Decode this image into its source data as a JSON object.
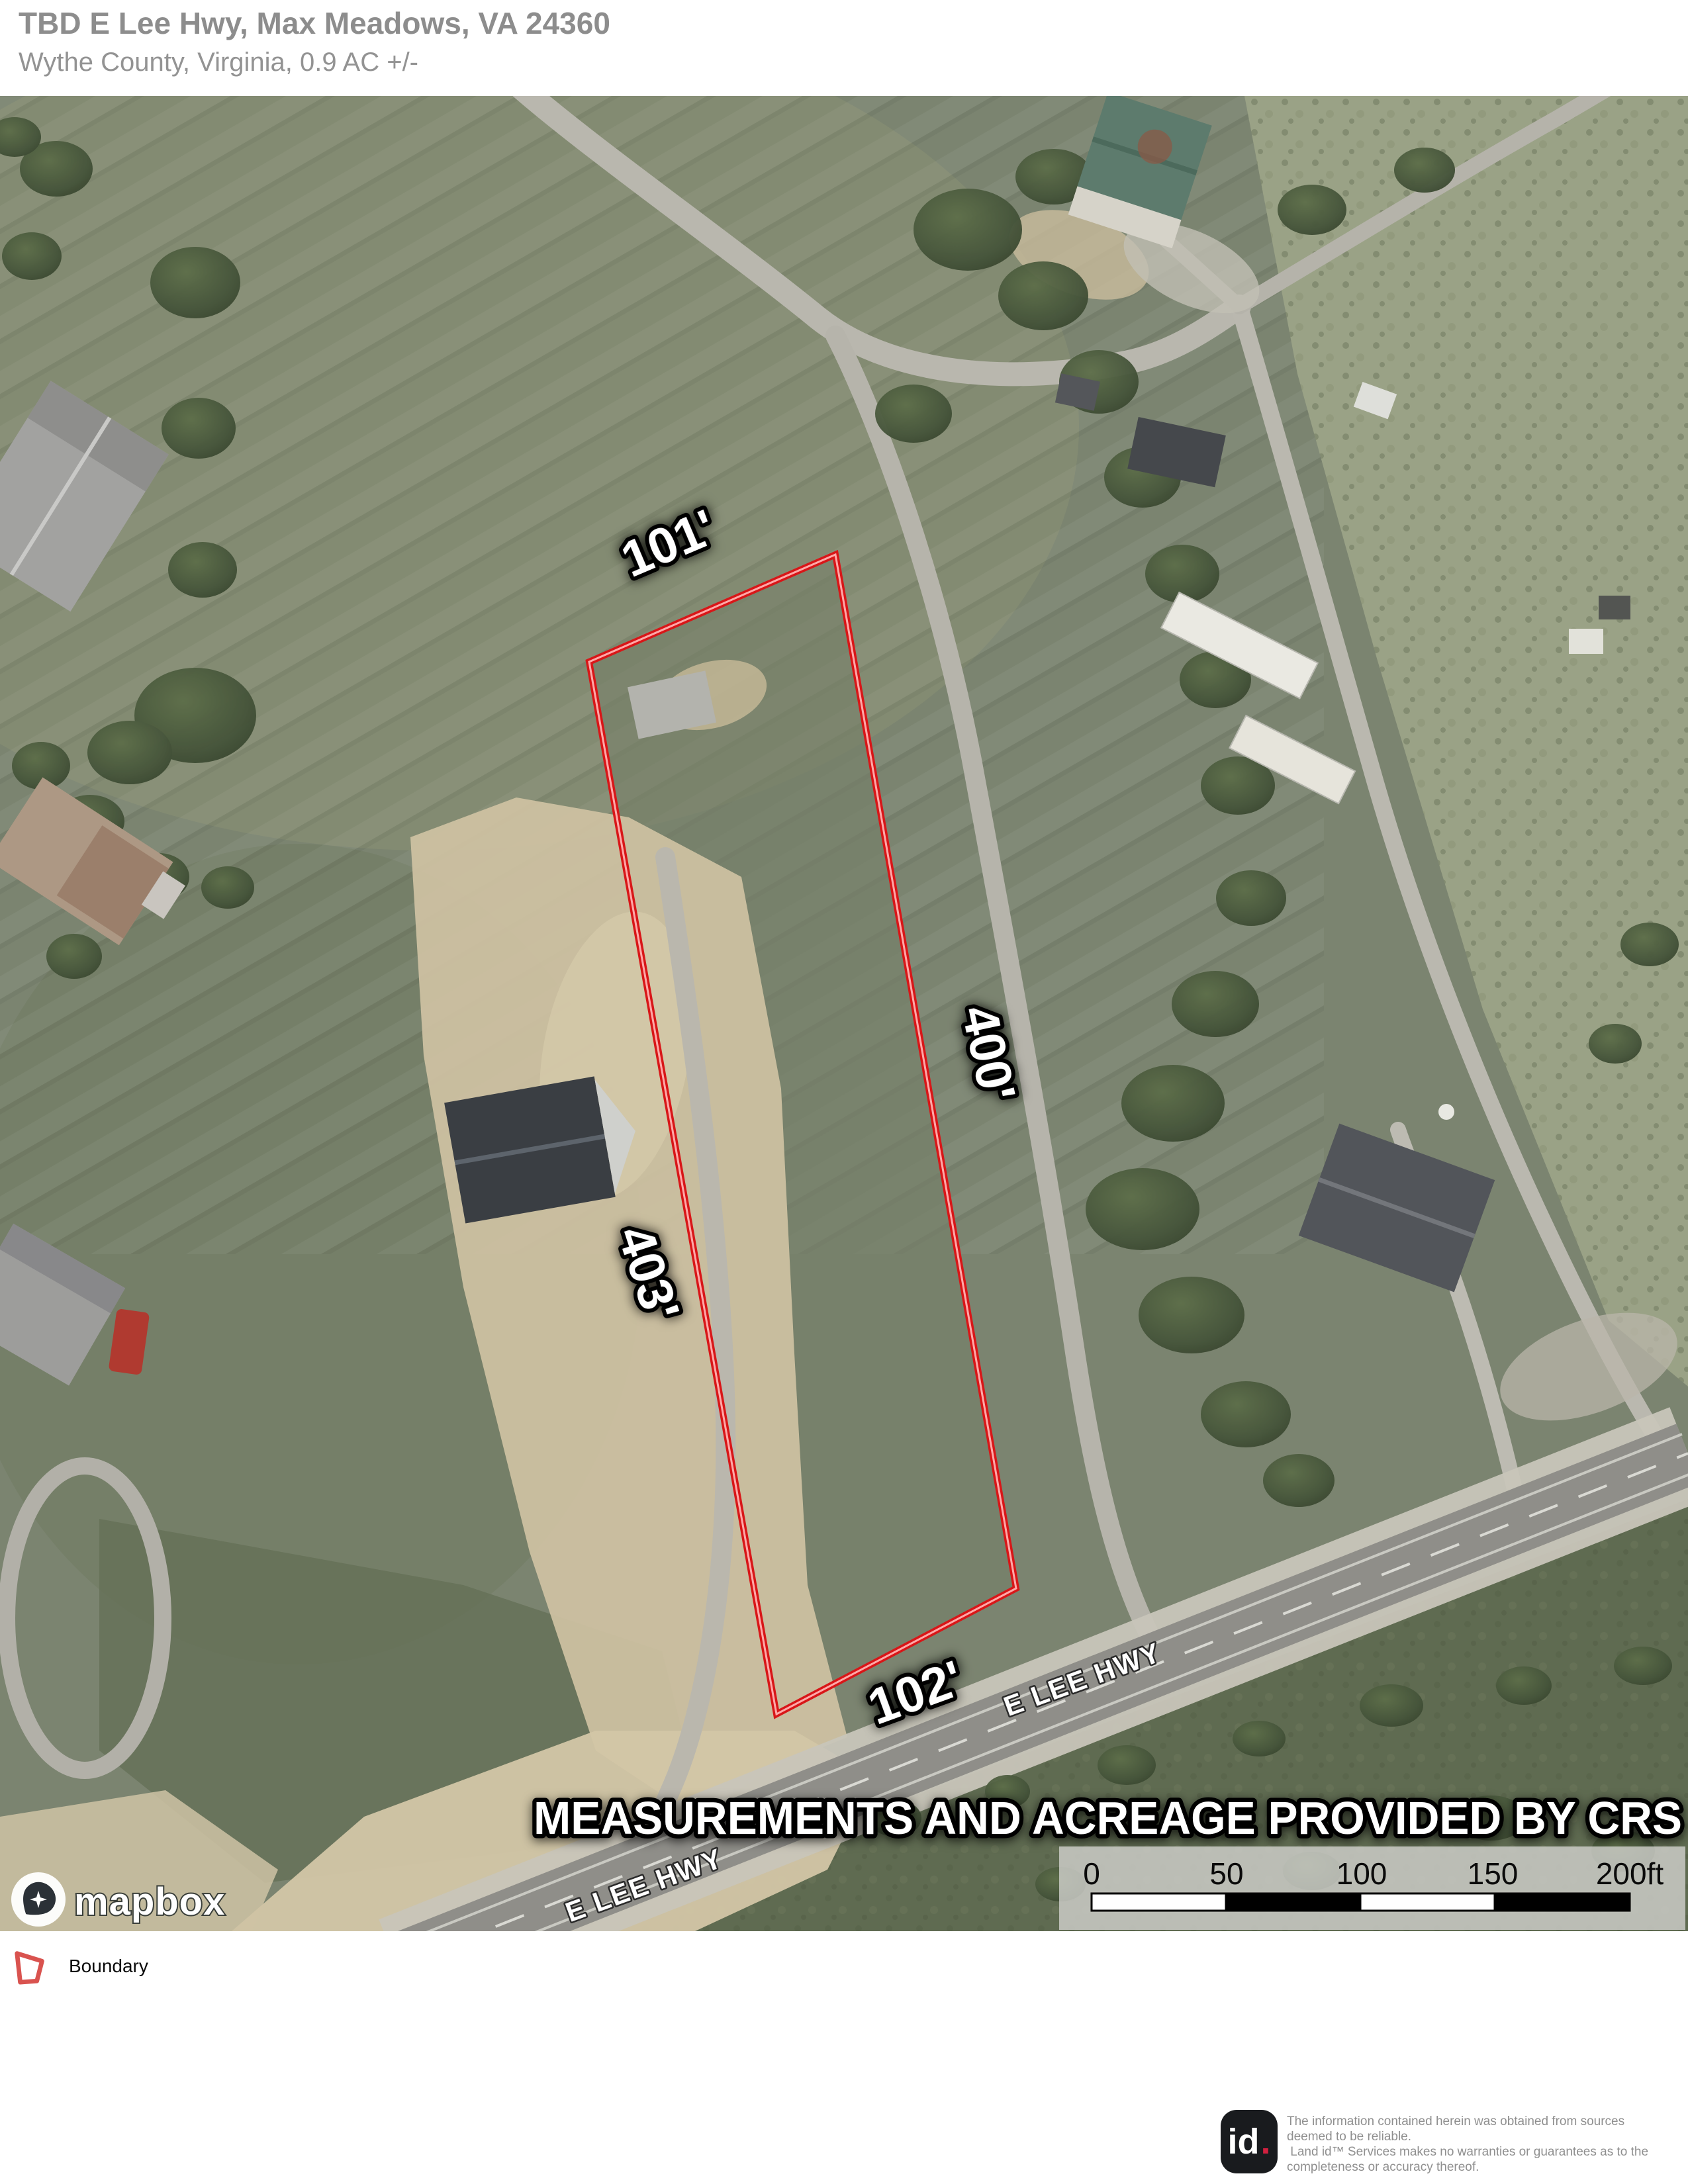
{
  "header": {
    "title": "TBD E Lee Hwy, Max Meadows, VA 24360",
    "subtitle": "Wythe County, Virginia, 0.9 AC +/-"
  },
  "map": {
    "measurements": {
      "top": "101'",
      "right": "400'",
      "left": "403'",
      "bottom": "102'"
    },
    "road_labels": {
      "upper": "E LEE HWY",
      "lower": "E LEE HWY"
    },
    "overlay_note": "MEASUREMENTS AND ACREAGE PROVIDED BY CRS",
    "scale_bar": {
      "ticks": [
        "0",
        "50",
        "100",
        "150",
        "200ft"
      ]
    },
    "attribution": "mapbox",
    "boundary_color": "#d81618"
  },
  "legend": {
    "boundary_label": "Boundary"
  },
  "footer": {
    "logo_id": "id",
    "logo_dot": ".",
    "disclaimer_lines": [
      "The information contained herein was obtained from sources",
      "deemed to be reliable.",
      " Land id™ Services makes no warranties or guarantees as to the",
      "completeness or accuracy thereof."
    ]
  }
}
